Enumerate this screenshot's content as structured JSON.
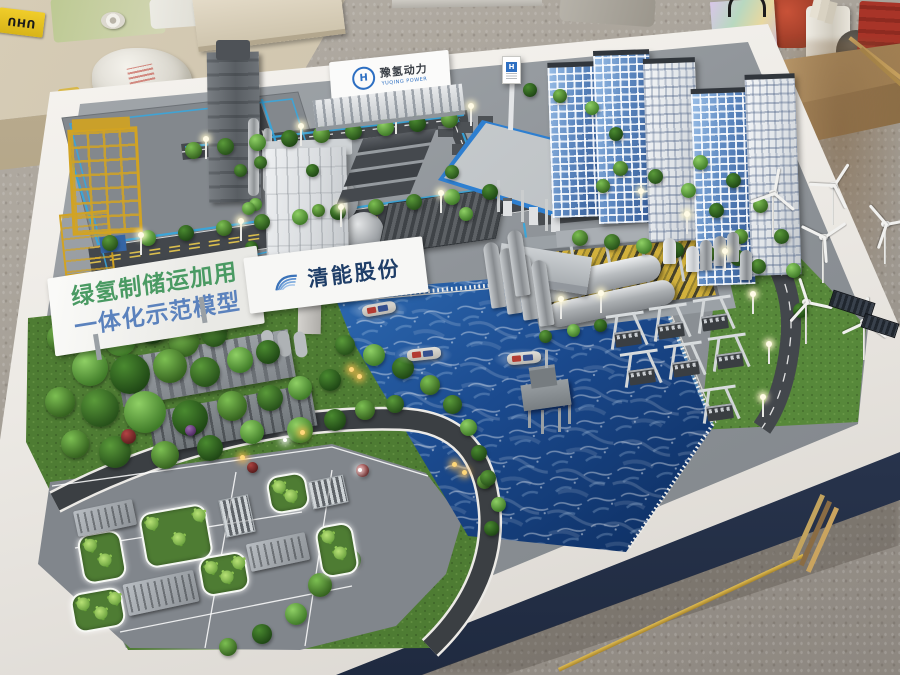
{
  "scene": {
    "description": "Workshop photograph of a physical scale model (sand table) of a green hydrogen industrial demonstration park"
  },
  "model": {
    "banner": {
      "line1": "绿氢制储运加用",
      "line2": "一体化示范模型"
    },
    "billboard": {
      "company": "清能股份"
    },
    "gate_sign": {
      "title": "豫氢动力",
      "subtitle": "YUQING POWER",
      "logo_letter": "H"
    },
    "totem_sign": {
      "logo_letter": "H"
    }
  },
  "workshop": {
    "glue_box_label": "UHU"
  },
  "palette": {
    "water": "#1b4a8e",
    "grass": "#4e7c33",
    "asphalt": "#43474c",
    "table_white": "#f2f0ec",
    "table_underside": "#2e3a52",
    "banner_line1": "#4a9a63",
    "banner_line2": "#5b82bd",
    "billboard_text": "#1f3e68",
    "pipeline_blue": "#35a8e0",
    "chimney_red": "#c8473a",
    "derrick_yellow": "#d2a322",
    "tube_yellow": "#d2b13c",
    "canopy_trim_blue": "#2e7fd0"
  }
}
